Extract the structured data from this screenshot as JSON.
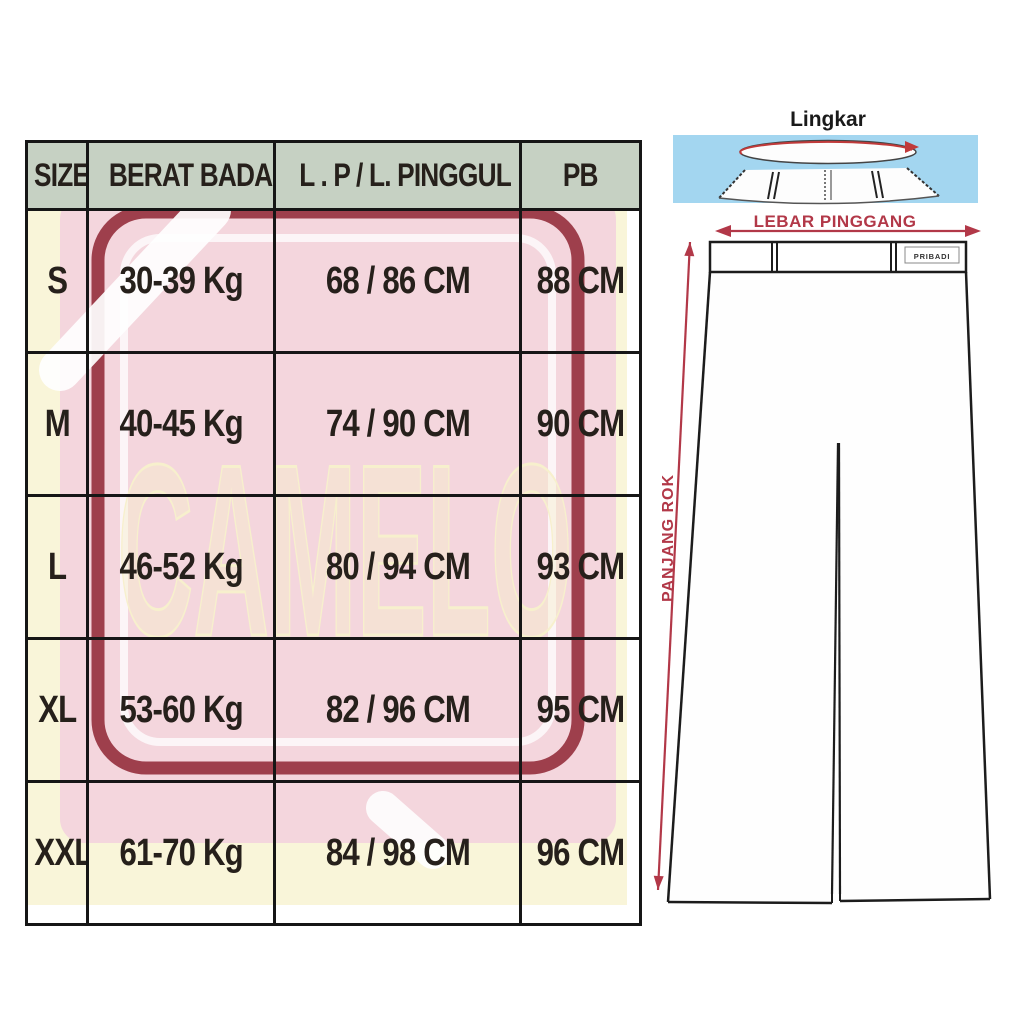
{
  "table": {
    "headers": [
      "SIZE",
      "BERAT BADAN",
      "L . P / L. PINGGUL",
      "PB"
    ],
    "rows": [
      {
        "size": "S",
        "berat_badan": "30-39 Kg",
        "lp_pinggul": "68 / 86 CM",
        "pb": "88 CM"
      },
      {
        "size": "M",
        "berat_badan": "40-45 Kg",
        "lp_pinggul": "74 / 90 CM",
        "pb": "90 CM"
      },
      {
        "size": "L",
        "berat_badan": "46-52 Kg",
        "lp_pinggul": "80 / 94 CM",
        "pb": "93 CM"
      },
      {
        "size": "XL",
        "berat_badan": "53-60 Kg",
        "lp_pinggul": "82 / 96 CM",
        "pb": "95 CM"
      },
      {
        "size": "XXL",
        "berat_badan": "61-70 Kg",
        "lp_pinggul": "84 / 98 CM",
        "pb": "96 CM"
      }
    ]
  },
  "watermark": {
    "text": "CAMELO"
  },
  "diagram": {
    "title": "Lingkar",
    "waist_width_label": "LEBAR PINGGANG",
    "skirt_length_label": "PANJANG ROK",
    "waistband_tag": "PRIBADI"
  },
  "colors": {
    "header_bg": "#c6d1c3",
    "cell_bg": "#f9f5d9",
    "watermark_pink": "#f4d6dd",
    "watermark_maroon": "#8e2433",
    "accent_red": "#b23848",
    "diagram_blue": "#a3d6f0",
    "grid_border": "#161616"
  }
}
